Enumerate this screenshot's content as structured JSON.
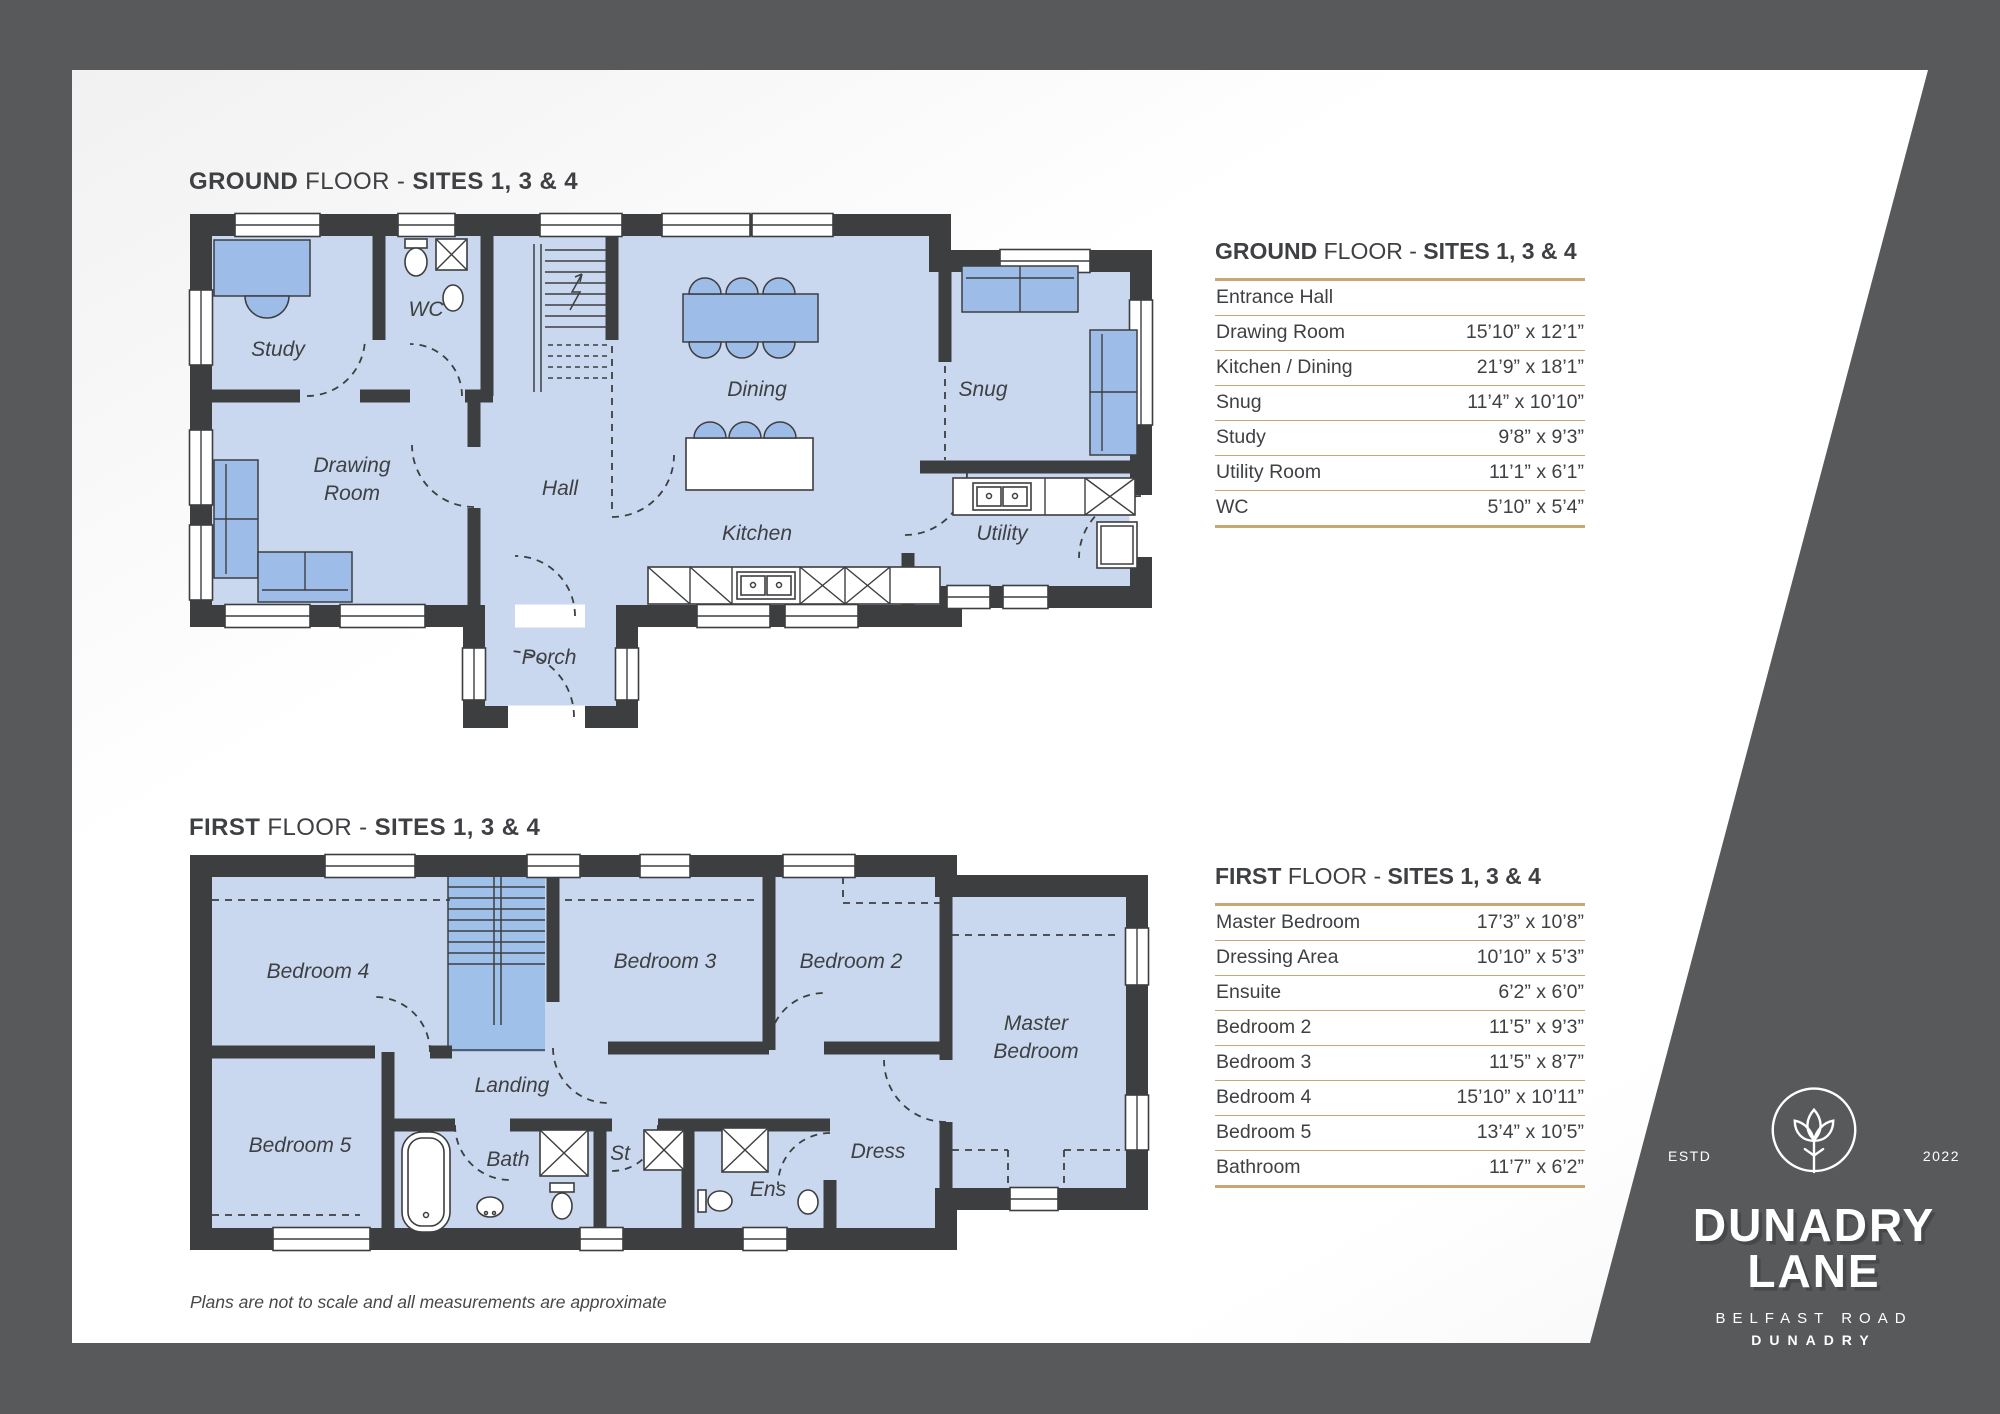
{
  "theme": {
    "background": "#58595B",
    "panel": "#FFFFFF",
    "wall": "#3D3E40",
    "room_fill": "#C9D8EF",
    "stair_fill": "#9FC0E8",
    "furniture_fill": "#9DBDE8",
    "table_rule_gold": "#C8A775",
    "text": "#3E4043"
  },
  "ground": {
    "title": {
      "b1": "GROUND",
      "mid": "FLOOR -",
      "b2": "SITES 1, 3 & 4"
    },
    "labels": [
      {
        "lines": [
          "Study"
        ],
        "x": 278,
        "y": 356
      },
      {
        "lines": [
          "WC"
        ],
        "x": 426,
        "y": 316
      },
      {
        "lines": [
          "Drawing",
          "Room"
        ],
        "x": 352,
        "y": 472
      },
      {
        "lines": [
          "Hall"
        ],
        "x": 560,
        "y": 495
      },
      {
        "lines": [
          "Porch"
        ],
        "x": 549,
        "y": 664
      },
      {
        "lines": [
          "Dining"
        ],
        "x": 757,
        "y": 396
      },
      {
        "lines": [
          "Kitchen"
        ],
        "x": 757,
        "y": 540
      },
      {
        "lines": [
          "Snug"
        ],
        "x": 983,
        "y": 396
      },
      {
        "lines": [
          "Utility"
        ],
        "x": 1002,
        "y": 540
      }
    ],
    "table": {
      "rows": [
        {
          "name": "Entrance Hall",
          "dims": ""
        },
        {
          "name": "Drawing Room",
          "dims": "15’10” x 12’1”"
        },
        {
          "name": "Kitchen / Dining",
          "dims": "21’9” x 18’1”"
        },
        {
          "name": "Snug",
          "dims": "11’4” x 10’10”"
        },
        {
          "name": "Study",
          "dims": "9’8” x 9’3”"
        },
        {
          "name": "Utility Room",
          "dims": "11’1” x 6’1”"
        },
        {
          "name": "WC",
          "dims": "5’10” x 5’4”"
        }
      ]
    }
  },
  "first": {
    "title": {
      "b1": "FIRST",
      "mid": "FLOOR -",
      "b2": "SITES 1, 3 & 4"
    },
    "labels": [
      {
        "lines": [
          "Bedroom 4"
        ],
        "x": 318,
        "y": 978
      },
      {
        "lines": [
          "Bedroom 5"
        ],
        "x": 300,
        "y": 1152
      },
      {
        "lines": [
          "Bedroom 3"
        ],
        "x": 665,
        "y": 968
      },
      {
        "lines": [
          "Bedroom 2"
        ],
        "x": 851,
        "y": 968
      },
      {
        "lines": [
          "Landing"
        ],
        "x": 512,
        "y": 1092
      },
      {
        "lines": [
          "Bath"
        ],
        "x": 508,
        "y": 1166
      },
      {
        "lines": [
          "St"
        ],
        "x": 620,
        "y": 1160
      },
      {
        "lines": [
          "Ens"
        ],
        "x": 768,
        "y": 1196
      },
      {
        "lines": [
          "Dress"
        ],
        "x": 878,
        "y": 1158
      },
      {
        "lines": [
          "Master",
          "Bedroom"
        ],
        "x": 1036,
        "y": 1030
      }
    ],
    "table": {
      "rows": [
        {
          "name": "Master Bedroom",
          "dims": "17’3” x 10’8”"
        },
        {
          "name": "Dressing Area",
          "dims": "10’10” x 5’3”"
        },
        {
          "name": "Ensuite",
          "dims": "6’2” x 6’0”"
        },
        {
          "name": "Bedroom 2",
          "dims": "11’5” x 9’3”"
        },
        {
          "name": "Bedroom 3",
          "dims": "11’5” x 8’7”"
        },
        {
          "name": "Bedroom 4",
          "dims": "15’10” x 10’11”"
        },
        {
          "name": "Bedroom 5",
          "dims": "13’4” x 10’5”"
        },
        {
          "name": "Bathroom",
          "dims": "11’7” x 6’2”"
        }
      ]
    }
  },
  "logo": {
    "estd": "ESTD",
    "year": "2022",
    "name_line1": "DUNADRY",
    "name_line2": "LANE",
    "road": "BELFAST ROAD",
    "town": "DUNADRY"
  },
  "disclaimer": "Plans are not to scale and all measurements are approximate"
}
